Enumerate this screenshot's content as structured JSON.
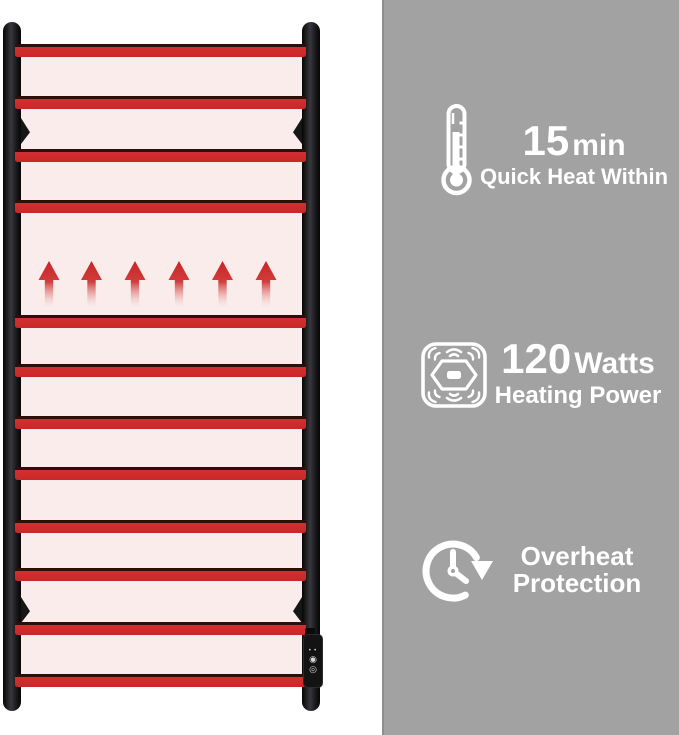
{
  "features": [
    {
      "icon": "thermometer-icon",
      "value": "15",
      "unit": "min",
      "label": "Quick Heat Within"
    },
    {
      "icon": "heating-power-icon",
      "value": "120",
      "unit": "Watts",
      "label": "Heating Power"
    },
    {
      "icon": "overheat-protection-icon",
      "label_line1": "Overheat",
      "label_line2": "Protection"
    }
  ],
  "product": {
    "rung_count": 12,
    "heat_arrow_count": 6,
    "control_panel": {
      "icons": [
        "indicator-dots",
        "power-icon",
        "timer-icon"
      ]
    },
    "colors": {
      "rail_red": "#d2302e",
      "rail_edge_dark": "#2b0f0f",
      "frame_black": "#161618",
      "heat_glow_pink": "#faeceb",
      "panel_gray": "#a2a2a2",
      "text_white": "#ffffff"
    }
  }
}
